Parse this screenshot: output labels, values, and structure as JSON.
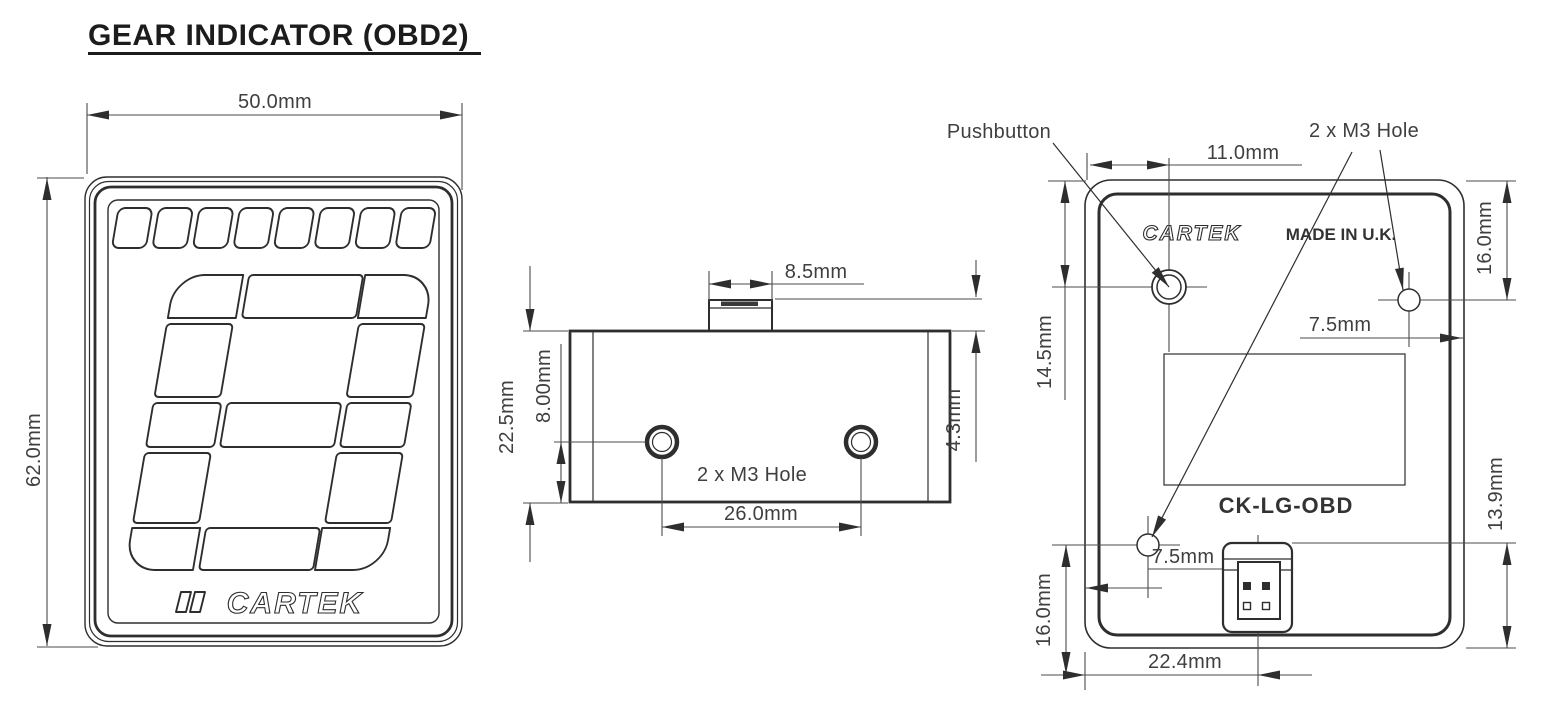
{
  "title": "GEAR INDICATOR (OBD2)",
  "front": {
    "width_dim": "50.0mm",
    "height_dim": "62.0mm",
    "logo": "CARTEK"
  },
  "side": {
    "tab_width_dim": "8.5mm",
    "body_height_dim": "22.5mm",
    "hole_offset_dim": "8.00mm",
    "tab_height_dim": "4.3mm",
    "hole_spacing_dim": "26.0mm",
    "holes_label": "2 x M3 Hole"
  },
  "back": {
    "pushbutton_label": "Pushbutton",
    "holes_label": "2 x M3 Hole",
    "pushbutton_x_dim": "11.0mm",
    "right_hole_top_dim": "16.0mm",
    "pushbutton_y_dim": "14.5mm",
    "right_hole_edge_dim": "7.5mm",
    "brand": "CARTEK",
    "made_in": "MADE IN U.K.",
    "model": "CK-LG-OBD",
    "connector_height_dim": "13.9mm",
    "bottom_hole_y_dim": "16.0mm",
    "bottom_hole_edge_dim": "7.5mm",
    "connector_x_dim": "22.4mm"
  }
}
